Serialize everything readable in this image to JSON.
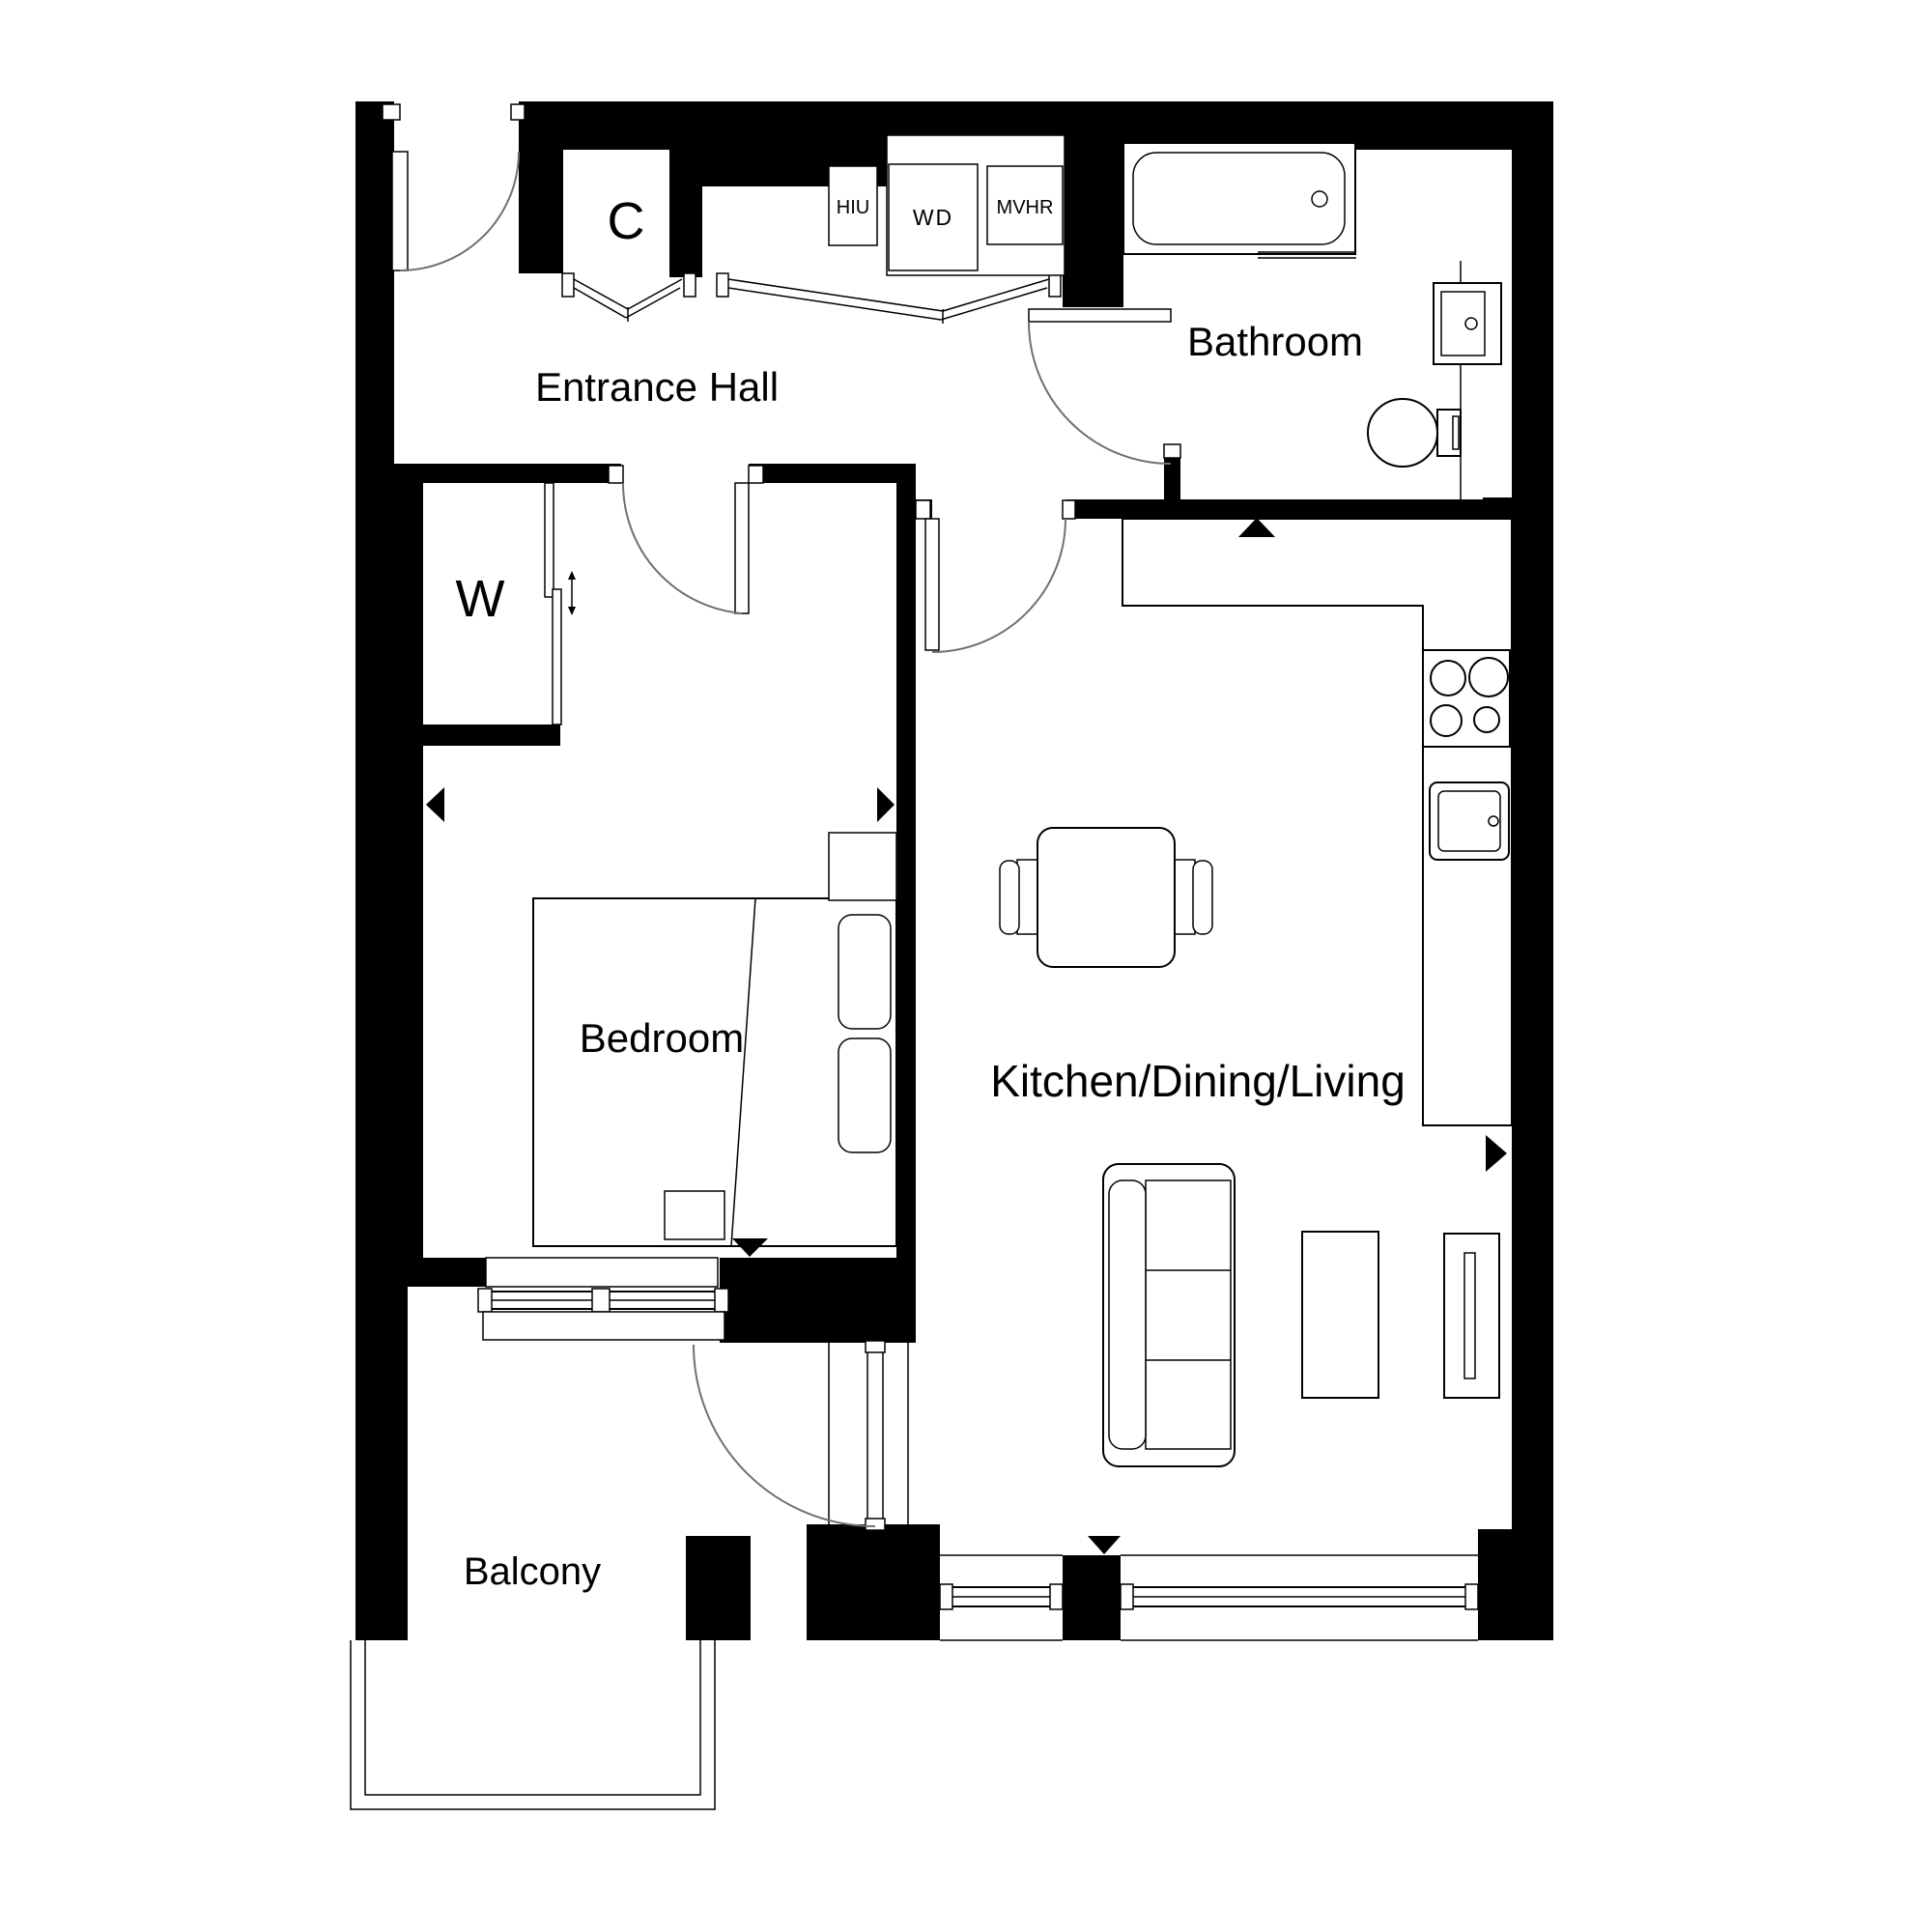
{
  "plan": {
    "title": "Apartment floor plan",
    "rooms": {
      "entrance_hall": {
        "label": "Entrance Hall"
      },
      "bathroom": {
        "label": "Bathroom"
      },
      "bedroom": {
        "label": "Bedroom"
      },
      "kitchen_dining_living": {
        "label": "Kitchen/Dining/Living"
      },
      "balcony": {
        "label": "Balcony"
      }
    },
    "storage": {
      "cupboard": {
        "label": "C"
      },
      "wardrobe": {
        "label": "W"
      }
    },
    "utilities": {
      "hiu": {
        "label": "HIU"
      },
      "wd": {
        "label": "WD"
      },
      "mvhr": {
        "label": "MVHR"
      }
    },
    "colors": {
      "wall": "#000000",
      "background": "#ffffff",
      "line": "#000000",
      "swing_arc": "#707070"
    }
  }
}
